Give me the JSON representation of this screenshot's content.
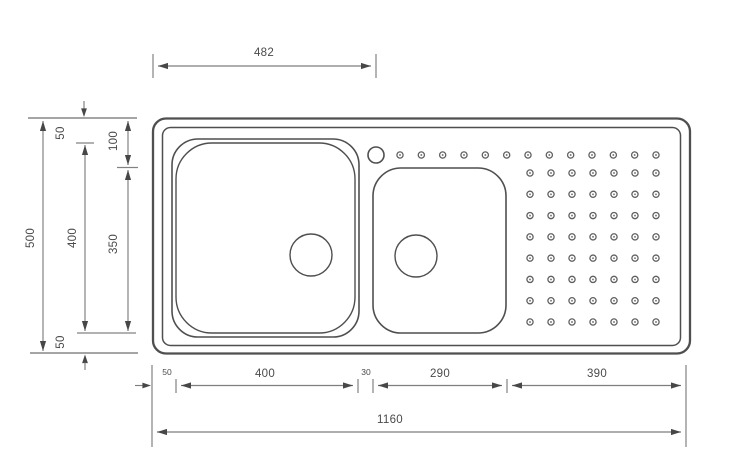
{
  "diagram": {
    "title": "Kitchen sink technical drawing, top view with dimensions",
    "units": "mm",
    "colors": {
      "background": "#ffffff",
      "drawing_line": "#4f4f4f",
      "dimension_line": "#7e7e7e",
      "dimension_text": "#4a4a4a"
    },
    "dimensions": {
      "top_width": "482",
      "overall_depth": "500",
      "top_margin": "50",
      "bowl1_depth": "400",
      "bowl2_top_offset": "100",
      "bowl2_depth": "350",
      "bottom_margin": "50",
      "left_margin": "50",
      "bowl1_width": "400",
      "bowl_gap": "30",
      "bowl2_width": "290",
      "drainer_width": "390",
      "overall_width": "1160"
    },
    "drainer": {
      "top_row_count": 13,
      "grid_cols": 7,
      "grid_rows": 8
    }
  }
}
